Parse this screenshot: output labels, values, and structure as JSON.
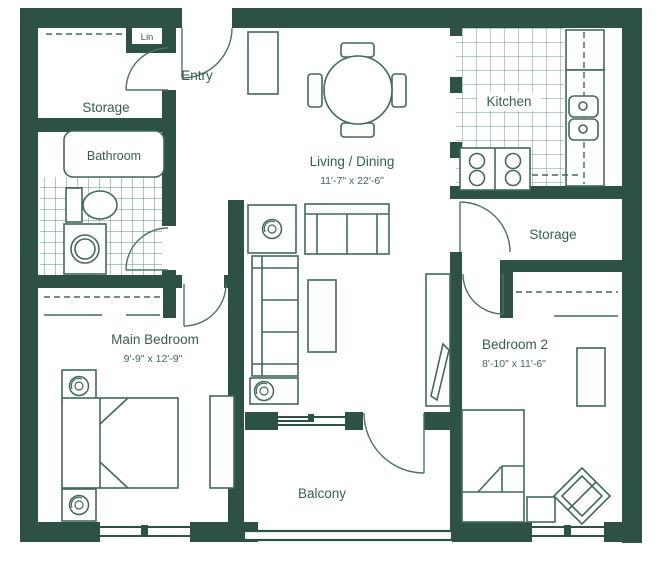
{
  "plan": {
    "title": "Two bedroom apartment floor plan",
    "rooms": {
      "lin": {
        "label": "Lin"
      },
      "entry": {
        "label": "Entry"
      },
      "storage_left": {
        "label": "Storage"
      },
      "bathroom": {
        "label": "Bathroom"
      },
      "kitchen": {
        "label": "Kitchen"
      },
      "living_dining": {
        "label": "Living / Dining",
        "dimensions": "11'-7\" x 22'-6\""
      },
      "storage_right": {
        "label": "Storage"
      },
      "main_bedroom": {
        "label": "Main Bedroom",
        "dimensions": "9'-9\" x 12'-9\""
      },
      "bedroom_2": {
        "label": "Bedroom 2",
        "dimensions": "8'-10\" x 11'-6\""
      },
      "balcony": {
        "label": "Balcony"
      }
    },
    "colors": {
      "wall": "#2d5144",
      "line": "#41695c",
      "tile": "#6f9c8d",
      "text": "#35604f",
      "background": "#ffffff"
    }
  }
}
